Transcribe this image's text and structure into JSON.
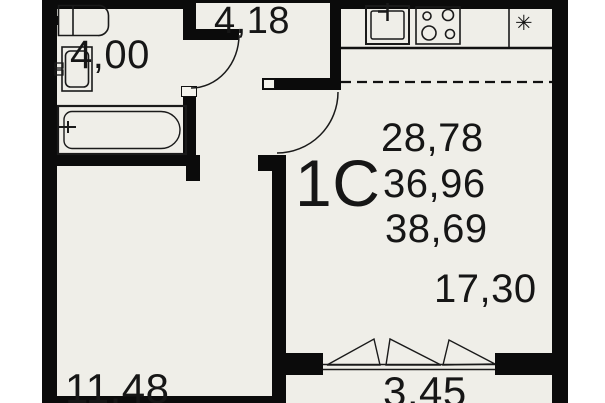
{
  "title": "apartment-floor-plan",
  "unit": {
    "type_label": "1C",
    "areas_list": [
      "28,78",
      "36,96",
      "38,69"
    ]
  },
  "rooms": {
    "hallway": {
      "area": "4,18"
    },
    "bathroom": {
      "area": "4,00"
    },
    "room": {
      "area": "11,48"
    },
    "living": {
      "area": "17,30"
    },
    "balcony": {
      "area": "3,45"
    }
  },
  "symbols": {
    "vent": "✳"
  },
  "colors": {
    "wall": "#0b0b0b",
    "paper": "#efeee8",
    "line": "#1a1a1a",
    "background": "#ffffff"
  }
}
